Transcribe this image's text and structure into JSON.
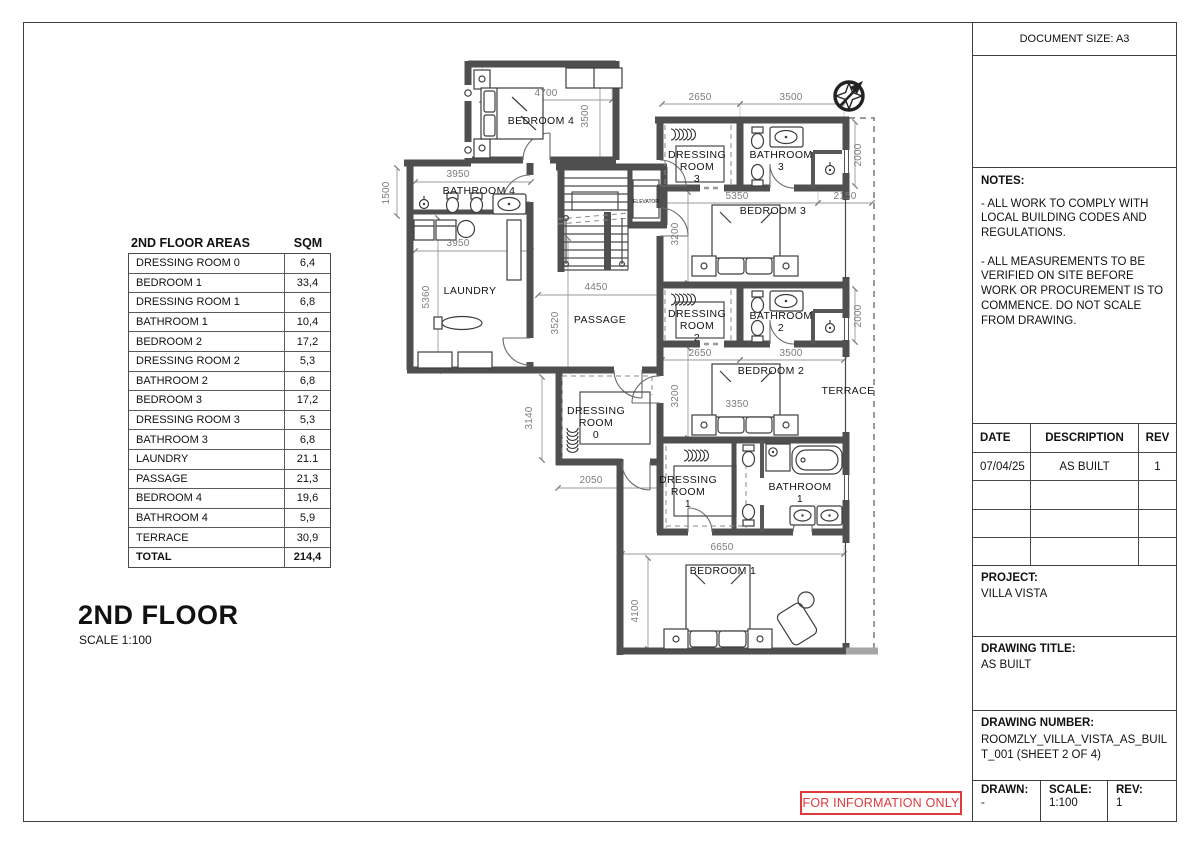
{
  "sheet": {
    "document_size": "DOCUMENT SIZE: A3",
    "stamp": "FOR INFORMATION ONLY"
  },
  "floor": {
    "title": "2ND FLOOR",
    "scale": "SCALE 1:100"
  },
  "areas_table": {
    "title": "2ND FLOOR AREAS",
    "unit": "SQM",
    "rows": [
      {
        "name": "DRESSING ROOM 0",
        "sqm": "6,4"
      },
      {
        "name": "BEDROOM 1",
        "sqm": "33,4"
      },
      {
        "name": "DRESSING ROOM 1",
        "sqm": "6,8"
      },
      {
        "name": "BATHROOM 1",
        "sqm": "10,4"
      },
      {
        "name": "BEDROOM 2",
        "sqm": "17,2"
      },
      {
        "name": "DRESSING ROOM 2",
        "sqm": "5,3"
      },
      {
        "name": "BATHROOM 2",
        "sqm": "6,8"
      },
      {
        "name": "BEDROOM 3",
        "sqm": "17,2"
      },
      {
        "name": "DRESSING ROOM 3",
        "sqm": "5,3"
      },
      {
        "name": "BATHROOM 3",
        "sqm": "6,8"
      },
      {
        "name": "LAUNDRY",
        "sqm": "21.1"
      },
      {
        "name": "PASSAGE",
        "sqm": "21,3"
      },
      {
        "name": "BEDROOM 4",
        "sqm": "19,6"
      },
      {
        "name": "BATHROOM 4",
        "sqm": "5,9"
      },
      {
        "name": "TERRACE",
        "sqm": "30,9"
      },
      {
        "name": "TOTAL",
        "sqm": "214,4"
      }
    ]
  },
  "notes": {
    "label": "NOTES:",
    "paragraphs": [
      "- ALL WORK TO COMPLY WITH LOCAL BUILDING CODES AND REGULATIONS.",
      "- ALL MEASUREMENTS TO BE VERIFIED ON SITE BEFORE WORK OR PROCUREMENT IS TO COMMENCE. DO NOT SCALE FROM DRAWING."
    ]
  },
  "revisions": {
    "headers": [
      "DATE",
      "DESCRIPTION",
      "REV"
    ],
    "rows": [
      [
        "07/04/25",
        "AS BUILT",
        "1"
      ],
      [
        "",
        "",
        ""
      ],
      [
        "",
        "",
        ""
      ],
      [
        "",
        "",
        ""
      ]
    ]
  },
  "project": {
    "label": "PROJECT:",
    "value": "VILLA VISTA"
  },
  "drawing_title": {
    "label": "DRAWING TITLE:",
    "value": "AS BUILT"
  },
  "drawing_number": {
    "label": "DRAWING NUMBER:",
    "value": "ROOMZLY_VILLA_VISTA_AS_BUILT_001 (SHEET 2 OF 4)"
  },
  "title_fields": {
    "drawn_label": "DRAWN:",
    "drawn": "-",
    "scale_label": "SCALE:",
    "scale": "1:100",
    "rev_label": "REV:",
    "rev": "1"
  },
  "plan": {
    "labels": [
      {
        "t": "BEDROOM 4",
        "x": 541,
        "y": 124,
        "c": "room"
      },
      {
        "t": "BATHROOM 4",
        "x": 479,
        "y": 194,
        "c": "room"
      },
      {
        "t": "LAUNDRY",
        "x": 470,
        "y": 294,
        "c": "room"
      },
      {
        "t": "PASSAGE",
        "x": 600,
        "y": 323,
        "c": "room"
      },
      {
        "t": "DRESSING",
        "x": 596,
        "y": 414,
        "c": "room"
      },
      {
        "t": "ROOM",
        "x": 596,
        "y": 426,
        "c": "room"
      },
      {
        "t": "0",
        "x": 596,
        "y": 438,
        "c": "room"
      },
      {
        "t": "DRESSING",
        "x": 697,
        "y": 158,
        "c": "room"
      },
      {
        "t": "ROOM",
        "x": 697,
        "y": 170,
        "c": "room"
      },
      {
        "t": "3",
        "x": 697,
        "y": 182,
        "c": "room"
      },
      {
        "t": "BATHROOM",
        "x": 781,
        "y": 158,
        "c": "room"
      },
      {
        "t": "3",
        "x": 781,
        "y": 170,
        "c": "room"
      },
      {
        "t": "BEDROOM 3",
        "x": 773,
        "y": 214,
        "c": "room"
      },
      {
        "t": "DRESSING",
        "x": 697,
        "y": 317,
        "c": "room"
      },
      {
        "t": "ROOM",
        "x": 697,
        "y": 329,
        "c": "room"
      },
      {
        "t": "2",
        "x": 697,
        "y": 341,
        "c": "room"
      },
      {
        "t": "BATHROOM",
        "x": 781,
        "y": 319,
        "c": "room"
      },
      {
        "t": "2",
        "x": 781,
        "y": 331,
        "c": "room"
      },
      {
        "t": "BEDROOM 2",
        "x": 771,
        "y": 374,
        "c": "room"
      },
      {
        "t": "TERRACE",
        "x": 848,
        "y": 394,
        "c": "room"
      },
      {
        "t": "DRESSING",
        "x": 688,
        "y": 483,
        "c": "room"
      },
      {
        "t": "ROOM",
        "x": 688,
        "y": 495,
        "c": "room"
      },
      {
        "t": "1",
        "x": 688,
        "y": 507,
        "c": "room"
      },
      {
        "t": "BATHROOM",
        "x": 800,
        "y": 490,
        "c": "room"
      },
      {
        "t": "1",
        "x": 800,
        "y": 502,
        "c": "room"
      },
      {
        "t": "BEDROOM 1",
        "x": 723,
        "y": 574,
        "c": "room"
      },
      {
        "t": "ELEVATOR",
        "x": 646,
        "y": 203,
        "c": "tiny"
      },
      {
        "t": "4700",
        "x": 546,
        "y": 96,
        "c": "dim"
      },
      {
        "t": "3500",
        "x": 588,
        "y": 116,
        "c": "dimv"
      },
      {
        "t": "1500",
        "x": 389,
        "y": 193,
        "c": "dimv"
      },
      {
        "t": "3950",
        "x": 458,
        "y": 177,
        "c": "dim"
      },
      {
        "t": "3950",
        "x": 458,
        "y": 246,
        "c": "dim"
      },
      {
        "t": "5360",
        "x": 429,
        "y": 297,
        "c": "dimv"
      },
      {
        "t": "4450",
        "x": 596,
        "y": 290,
        "c": "dim"
      },
      {
        "t": "3520",
        "x": 558,
        "y": 323,
        "c": "dimv"
      },
      {
        "t": "3140",
        "x": 532,
        "y": 418,
        "c": "dimv"
      },
      {
        "t": "2050",
        "x": 591,
        "y": 483,
        "c": "dim"
      },
      {
        "t": "2650",
        "x": 700,
        "y": 100,
        "c": "dim"
      },
      {
        "t": "3500",
        "x": 791,
        "y": 100,
        "c": "dim"
      },
      {
        "t": "2000",
        "x": 861,
        "y": 155,
        "c": "dimv"
      },
      {
        "t": "5350",
        "x": 737,
        "y": 199,
        "c": "dim"
      },
      {
        "t": "2150",
        "x": 845,
        "y": 199,
        "c": "dim"
      },
      {
        "t": "3200",
        "x": 678,
        "y": 234,
        "c": "dimv"
      },
      {
        "t": "2000",
        "x": 861,
        "y": 316,
        "c": "dimv"
      },
      {
        "t": "2650",
        "x": 700,
        "y": 356,
        "c": "dim"
      },
      {
        "t": "3500",
        "x": 791,
        "y": 356,
        "c": "dim"
      },
      {
        "t": "3200",
        "x": 678,
        "y": 396,
        "c": "dimv"
      },
      {
        "t": "3350",
        "x": 737,
        "y": 407,
        "c": "dim"
      },
      {
        "t": "6650",
        "x": 722,
        "y": 550,
        "c": "dim"
      },
      {
        "t": "4100",
        "x": 638,
        "y": 611,
        "c": "dimv"
      }
    ]
  }
}
